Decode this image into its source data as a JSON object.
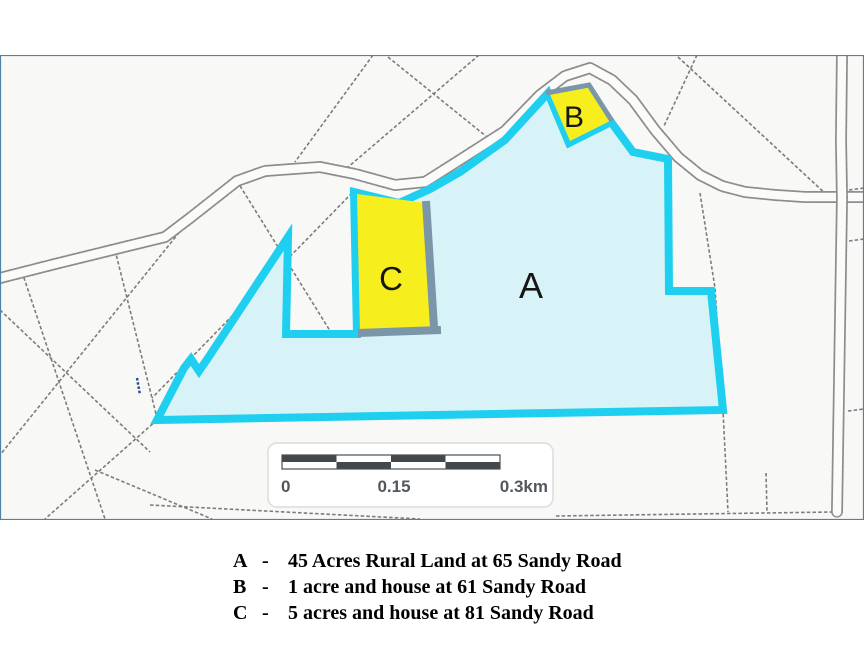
{
  "map": {
    "parcel_labels": {
      "a": "A",
      "b": "B",
      "c": "C"
    },
    "scale_bar": {
      "tick_start": "0",
      "tick_mid": "0.15",
      "tick_end": "0.3km"
    },
    "colors": {
      "highlight_fill": "#d7f3f8",
      "highlight_stroke": "#1fcff0",
      "parcel_fill_yellow": "#f7ee1e",
      "parcel_border_slate": "#7a96a8",
      "scale_dark": "#42484c",
      "frame": "#4e82a6"
    }
  },
  "legend": {
    "separator": "-",
    "items": [
      {
        "key": "A",
        "description": "45 Acres Rural Land at 65 Sandy Road"
      },
      {
        "key": "B",
        "description": "1 acre and house at 61 Sandy Road"
      },
      {
        "key": "C",
        "description": "5 acres and house at 81 Sandy Road"
      }
    ]
  }
}
